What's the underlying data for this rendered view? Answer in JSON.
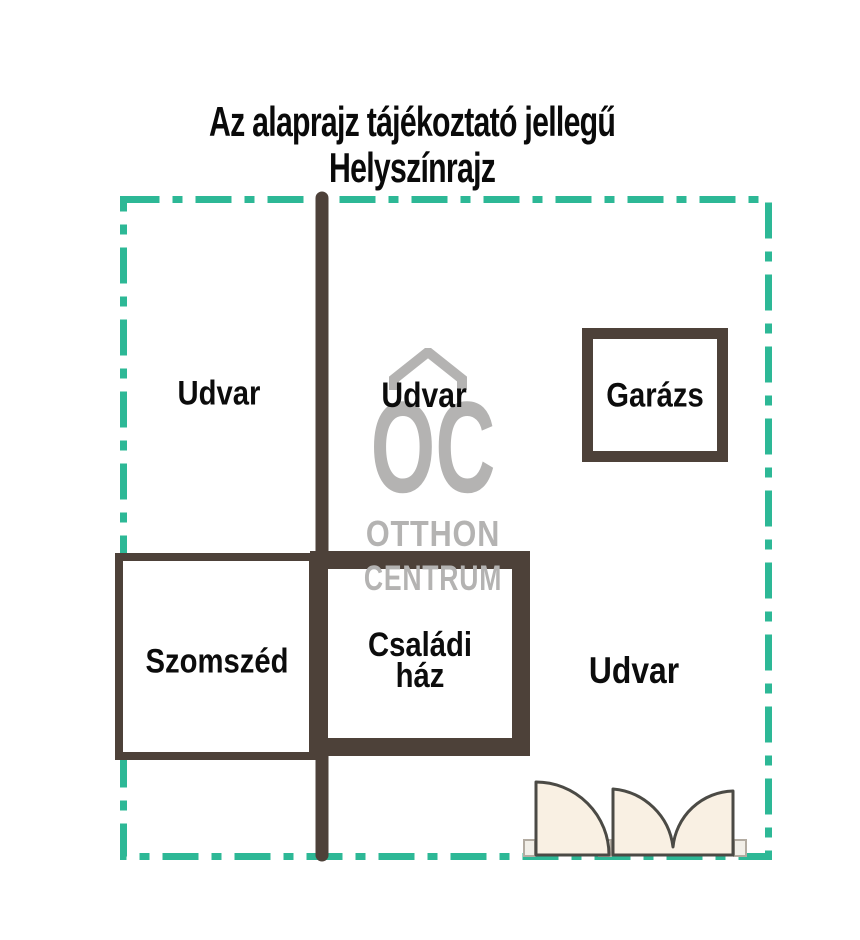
{
  "title": {
    "line1": "Az alaprajz tájékoztató jellegű",
    "line2": "Helyszínrajz"
  },
  "labels": {
    "yard_top_left": "Udvar",
    "yard_middle": "Udvar",
    "yard_bottom_right": "Udvar",
    "garage": "Garázs",
    "neighbor": "Szomszéd",
    "family_house": {
      "line1": "Családi",
      "line2": "ház"
    }
  },
  "watermark": {
    "initials": "OC",
    "name_line1": "OTTHON",
    "name_line2": "CENTRUM"
  },
  "colors": {
    "boundary_teal": "#2db896",
    "wall_brown": "#4d4139",
    "watermark_gray": "#b4b3b2",
    "door_fill": "#f9f0e3",
    "door_stroke": "#4b4a45"
  }
}
